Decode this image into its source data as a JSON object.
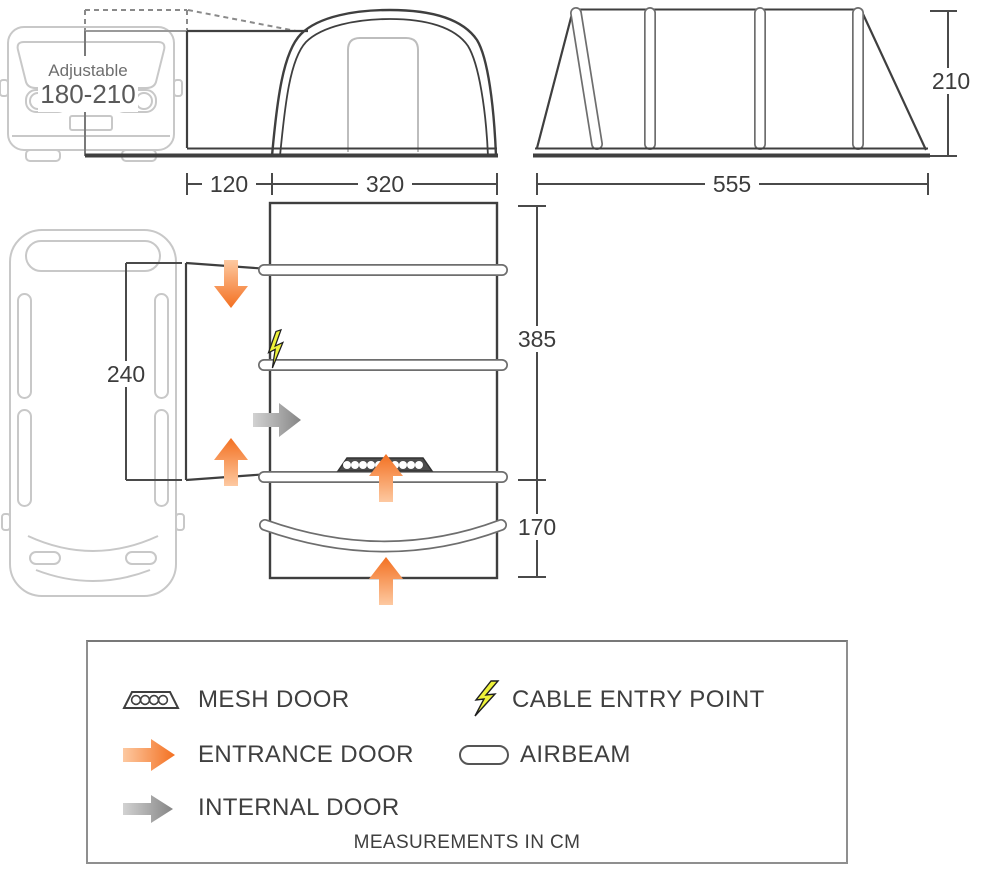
{
  "diagram": {
    "title": "Driveaway awning dimensions",
    "front_view": {
      "adjustable_label": "Adjustable",
      "adjustable_range": "180-210",
      "tunnel_width": "120",
      "body_width": "320"
    },
    "side_view": {
      "length": "555",
      "height": "210"
    },
    "plan_view": {
      "opening_height": "240",
      "main_length": "385",
      "porch_depth": "170"
    },
    "legend": {
      "items": [
        {
          "icon": "mesh-door-icon",
          "label": "MESH DOOR"
        },
        {
          "icon": "entrance-door-icon",
          "label": "ENTRANCE DOOR"
        },
        {
          "icon": "internal-door-icon",
          "label": "INTERNAL DOOR"
        },
        {
          "icon": "cable-entry-point-icon",
          "label": "CABLE ENTRY POINT"
        },
        {
          "icon": "airbeam-icon",
          "label": "AIRBEAM"
        }
      ],
      "note": "MEASUREMENTS IN CM"
    },
    "colors": {
      "orange": "#f37021",
      "orange_light": "#fdc9a1",
      "grey_arrow": "#8c8c8c",
      "grey_arrow_light": "#d2d2d2",
      "bolt_yellow": "#eef23a",
      "line_dark": "#3f3f3f",
      "dim_grey": "#4a4a4a",
      "van_grey": "#c8c8c8",
      "beam_grey": "#6e6e6e"
    }
  }
}
